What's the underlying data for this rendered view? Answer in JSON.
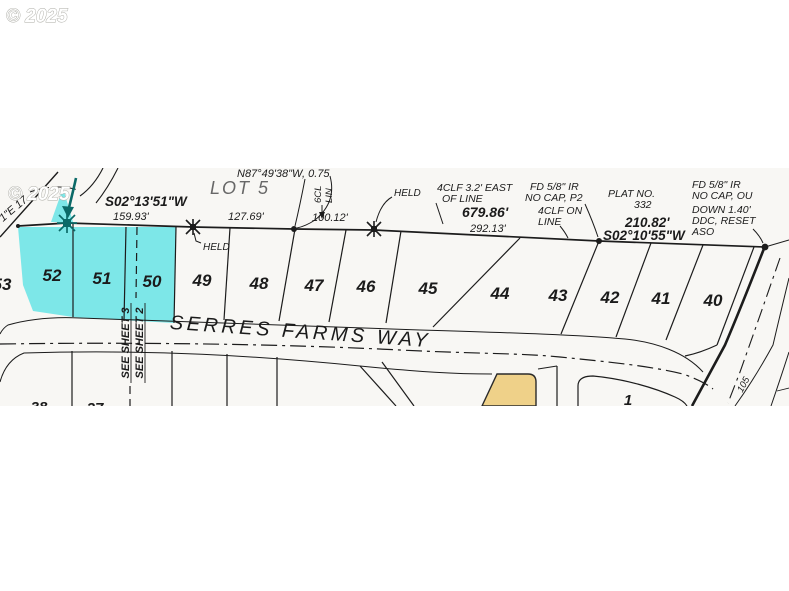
{
  "watermark": {
    "top": "© 2025",
    "map": "© 2025"
  },
  "survey": {
    "partial_bearing_left": "1\"E 17",
    "bearing_sw1": "S02°13'51\"W",
    "dist_159": "159.93'",
    "bearing_n87": "N87°49'38\"W, 0.75",
    "lot5": "LOT 5",
    "dist_127": "127.69'",
    "dist_100": "100.12'",
    "fence_6cl_1": "6CL",
    "fence_6cl_2": "LIN",
    "held": "HELD",
    "clf_east_line1": "4CLF 3.2' EAST",
    "clf_east_line2": "OF LINE",
    "fd_p2_line1": "FD 5/8\" IR",
    "fd_p2_line2": "NO CAP, P2",
    "dist_679": "679.86'",
    "dist_292": "292.13'",
    "clf_on_line1": "4CLF ON",
    "clf_on_line2": "LINE",
    "plat_no_line1": "PLAT NO.",
    "plat_no_line2": "332",
    "dist_210": "210.82'",
    "bearing_sw2": "S02°10'55\"W",
    "fd_right_lines": [
      "FD 5/8\" IR",
      "NO CAP, OU",
      "DOWN 1.40'",
      "DDC, RESET",
      "ASO"
    ]
  },
  "lots_top": [
    "53",
    "52",
    "51",
    "50",
    "49",
    "48",
    "47",
    "46",
    "45",
    "44",
    "43",
    "42",
    "41",
    "40"
  ],
  "lots_bottom": {
    "lot38": "38",
    "lot37": "37",
    "lot1": "1"
  },
  "street": {
    "name": "SERRES FARMS WAY"
  },
  "match_line": {
    "sheet3": "SEE SHEET 3",
    "sheet2": "SEE SHEET 2"
  },
  "road_right": {
    "label_105": "105"
  },
  "colors": {
    "highlight_cyan": "#7de7e8",
    "highlight_tan": "#efd189",
    "annotation_teal": "#0b6a68",
    "linework": "#1c1c1c"
  }
}
